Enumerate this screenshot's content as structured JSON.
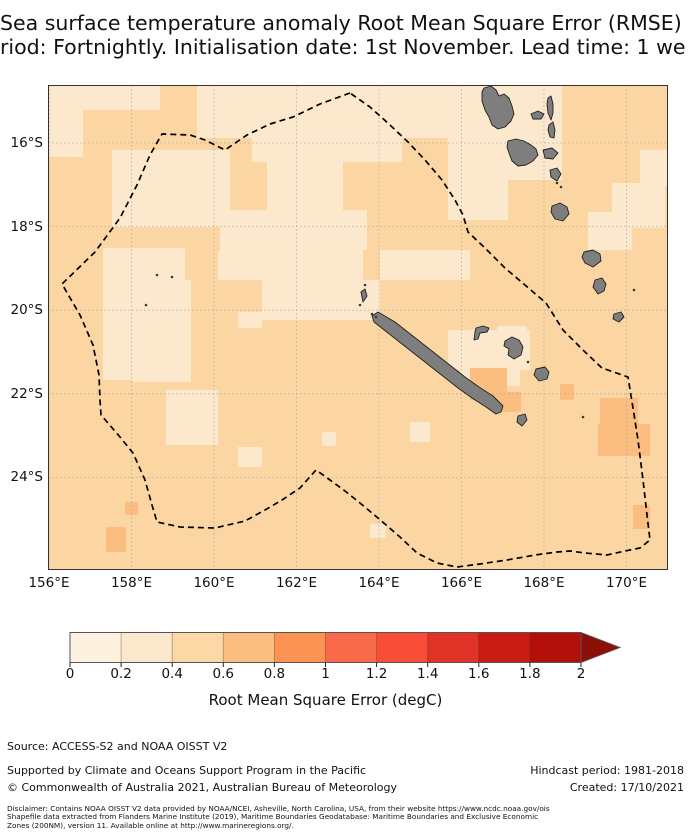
{
  "title": {
    "line1": "Sea surface temperature anomaly Root Mean Square Error (RMSE)",
    "line2": "riod: Fortnightly. Initialisation date: 1st November. Lead time: 1 we"
  },
  "map": {
    "x_ticks": [
      "156°E",
      "158°E",
      "160°E",
      "162°E",
      "164°E",
      "166°E",
      "168°E",
      "170°E"
    ],
    "y_ticks": [
      "16°S",
      "18°S",
      "20°S",
      "22°S",
      "24°S"
    ],
    "grid": {
      "x_px": [
        49,
        131.5,
        214,
        296.5,
        379,
        461.5,
        544,
        626.5
      ],
      "y_px": [
        143,
        226.6,
        310.2,
        393.8,
        477.4
      ]
    },
    "colors": {
      "base": "#fbd6a2",
      "light": "#fce9cd",
      "dark": "#fcbd81"
    },
    "patches": {
      "light": [
        [
          48,
          85,
          112,
          25
        ],
        [
          48,
          110,
          35,
          47
        ],
        [
          197,
          85,
          272,
          53
        ],
        [
          252,
          136,
          150,
          26
        ],
        [
          112,
          150,
          118,
          77
        ],
        [
          267,
          162,
          76,
          65
        ],
        [
          220,
          210,
          147,
          40
        ],
        [
          103,
          248,
          82,
          132
        ],
        [
          218,
          250,
          145,
          30
        ],
        [
          262,
          280,
          118,
          40
        ],
        [
          133,
          280,
          58,
          102
        ],
        [
          166,
          390,
          52,
          55
        ],
        [
          238,
          312,
          24,
          16
        ],
        [
          380,
          250,
          90,
          30
        ],
        [
          448,
          85,
          114,
          95
        ],
        [
          448,
          180,
          60,
          40
        ],
        [
          448,
          330,
          82,
          40
        ],
        [
          460,
          352,
          60,
          34
        ],
        [
          497,
          326,
          30,
          22
        ],
        [
          612,
          183,
          53,
          45
        ],
        [
          588,
          212,
          44,
          38
        ],
        [
          370,
          524,
          16,
          14
        ],
        [
          410,
          422,
          20,
          20
        ],
        [
          238,
          447,
          24,
          20
        ],
        [
          322,
          432,
          14,
          14
        ],
        [
          640,
          150,
          28,
          36
        ]
      ],
      "dark": [
        [
          470,
          368,
          37,
          32
        ],
        [
          495,
          392,
          26,
          20
        ],
        [
          600,
          398,
          38,
          28
        ],
        [
          598,
          424,
          52,
          32
        ],
        [
          633,
          505,
          17,
          24
        ],
        [
          125,
          502,
          13,
          13
        ],
        [
          106,
          527,
          20,
          25
        ],
        [
          560,
          384,
          14,
          16
        ]
      ]
    },
    "eez_points": "350,93 320,104 293,117 270,124 247,135 225,150 205,140 190,135 162,134 150,155 137,185 120,218 95,252 62,284 80,315 93,345 99,375 100,400 101,415 120,437 133,453 145,480 152,505 157,522 180,527 215,528 245,521 265,510 282,500 300,488 316,470 330,480 345,491 360,503 378,518 400,537 417,553 437,563 457,567 480,564 507,560 535,555 557,552 570,551 585,553 607,555 625,551 640,548 650,540 647,515 643,480 638,440 633,408 628,377 602,368 583,350 563,330 546,303 525,285 505,268 485,248 468,232 463,215 455,200 442,180 425,160 408,142 390,125 370,107",
    "islands": [
      {
        "name": "grande-terre",
        "points": "378,312 395,322 409,333 423,344 437,355 451,366 465,377 479,387 493,396 503,406 501,412 496,414 486,407 472,398 458,388 444,377 430,366 416,355 402,344 388,333 374,322 372,316"
      },
      {
        "name": "belep",
        "points": "361,292 365,289 367,296 363,302"
      },
      {
        "name": "ouvea",
        "points": "476,328 483,326 489,328 487,332 480,333 478,339 474,340 475,332"
      },
      {
        "name": "lifou",
        "points": "505,341 512,337 519,340 523,347 521,355 514,359 508,355 509,349 504,346"
      },
      {
        "name": "mare",
        "points": "536,369 545,367 549,372 547,379 539,381 534,375"
      },
      {
        "name": "ile-des-pins",
        "points": "518,416 525,414 527,420 522,426 517,422"
      },
      {
        "name": "espiritu-santo",
        "points": "484,88 491,86 496,90 499,96 504,94 509,98 512,106 514,114 511,121 505,127 498,129 492,125 489,117 485,110 482,101 482,92"
      },
      {
        "name": "maewo",
        "points": "548,98 551,96 553,104 553,113 551,120 548,113 547,104"
      },
      {
        "name": "aoba",
        "points": "531,114 538,111 544,114 541,119 533,119"
      },
      {
        "name": "pentecost",
        "points": "549,125 553,122 555,130 554,138 550,137 548,130"
      },
      {
        "name": "malakula",
        "points": "508,141 516,139 524,141 531,145 536,149 538,155 533,161 526,165 518,166 512,161 509,153 507,147"
      },
      {
        "name": "ambrym",
        "points": "543,150 552,148 558,153 553,159 545,158"
      },
      {
        "name": "epi",
        "points": "550,170 557,168 561,174 557,181 551,177"
      },
      {
        "name": "efate",
        "points": "552,206 560,203 567,207 569,214 563,221 555,219 551,212"
      },
      {
        "name": "erromango",
        "points": "584,252 593,250 600,254 601,261 593,267 585,263 582,257"
      },
      {
        "name": "tanna",
        "points": "595,280 602,278 606,284 604,291 598,294 593,287"
      },
      {
        "name": "aneityum",
        "points": "614,314 621,312 624,317 619,322 613,319"
      }
    ],
    "specks": [
      [
        557,
        183
      ],
      [
        561,
        187
      ],
      [
        528,
        362
      ],
      [
        583,
        417
      ],
      [
        146,
        305
      ],
      [
        157,
        275
      ],
      [
        172,
        277
      ],
      [
        634,
        290
      ],
      [
        360,
        305
      ],
      [
        372,
        314
      ],
      [
        376,
        317
      ],
      [
        365,
        285
      ]
    ]
  },
  "colorbar": {
    "ticks": [
      "0",
      "0.2",
      "0.4",
      "0.6",
      "0.8",
      "1",
      "1.2",
      "1.4",
      "1.6",
      "1.8",
      "2"
    ],
    "tick_x_px": [
      70,
      121.1,
      172.2,
      223.3,
      274.4,
      325.5,
      376.6,
      427.7,
      478.8,
      529.9,
      581
    ],
    "colors": [
      "#fdf2e0",
      "#fce8cd",
      "#fbd8a5",
      "#fcbd81",
      "#fb9355",
      "#f96a4a",
      "#f84d36",
      "#e03227",
      "#c91c13",
      "#b30f0b"
    ],
    "arrow_color": "#8c1007",
    "label": "Root Mean Square Error (degC)"
  },
  "footer": {
    "source": "Source: ACCESS-S2 and NOAA OISST V2",
    "supported": "Supported by Climate and Oceans Support Program in the Pacific",
    "copyright": "© Commonwealth of Australia 2021, Australian Bureau of Meteorology",
    "hindcast": "Hindcast period: 1981-2018",
    "created": "Created: 17/10/2021",
    "disclaimer_lines": [
      "Disclaimer: Contains NOAA OISST V2 data provided by NOAA/NCEI, Asheville, North Carolina, USA, from their website https://www.ncdc.noaa.gov/ois",
      "Shapefile data extracted from Flanders Marine Institute (2019), Maritime Boundaries Geodatabase: Maritime Boundaries and Exclusive Economic",
      "Zones (200NM), version 11. Available online at http://www.marineregions.org/."
    ]
  },
  "chart_data": {
    "type": "heatmap",
    "title": "Sea surface temperature anomaly Root Mean Square Error (RMSE)",
    "subtitle_visible": "riod: Fortnightly. Initialisation date: 1st November. Lead time: 1 we",
    "x_tick_labels": [
      "156°E",
      "158°E",
      "160°E",
      "162°E",
      "164°E",
      "166°E",
      "168°E",
      "170°E"
    ],
    "y_tick_labels": [
      "16°S",
      "18°S",
      "20°S",
      "22°S",
      "24°S"
    ],
    "x_range_deg_east": [
      156,
      171.1
    ],
    "y_range_deg_south": [
      14.6,
      26.2
    ],
    "colorbar": {
      "label": "Root Mean Square Error (degC)",
      "ticks": [
        0,
        0.2,
        0.4,
        0.6,
        0.8,
        1,
        1.2,
        1.4,
        1.6,
        1.8,
        2
      ],
      "extend": "max",
      "units": "degC"
    },
    "value_summary": [
      {
        "value_range": [
          0.2,
          0.4
        ],
        "where": "large patches in the north and central-west of the domain, around northern Vanuatu, and along 170E near 18-19S"
      },
      {
        "value_range": [
          0.4,
          0.6
        ],
        "where": "most of the remaining domain (background value)"
      },
      {
        "value_range": [
          0.6,
          0.8
        ],
        "where": "south/southwest of New Caledonia, near 170E 22-23S, and the far southwest corner near 157E 25S"
      }
    ],
    "overlays": [
      "New Caledonia EEZ dashed boundary",
      "gray landmasses: New Caledonia, Loyalty Islands, Vanuatu chain"
    ]
  }
}
